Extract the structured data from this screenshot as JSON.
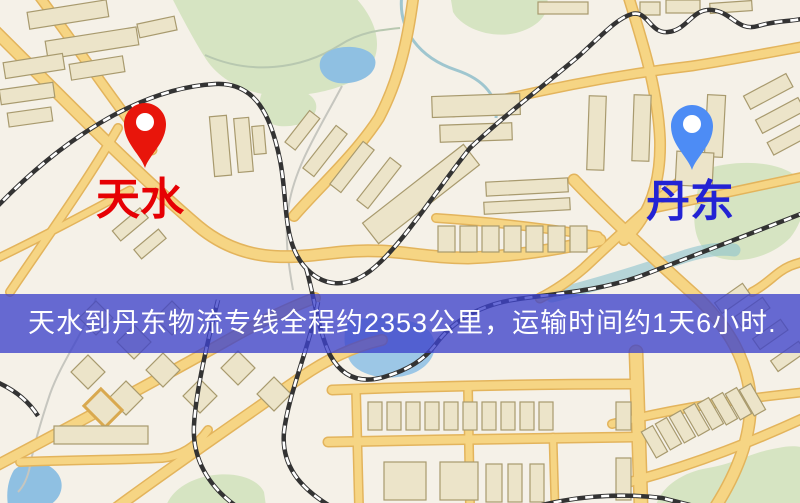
{
  "map": {
    "origin": {
      "name": "天水",
      "pin_color": "#e8150b",
      "label_color": "#e60004"
    },
    "destination": {
      "name": "丹东",
      "pin_color": "#4d8cf5",
      "label_color": "#2323d4"
    },
    "banner": {
      "text": "天水到丹东物流专线全程约2353公里，运输时间约1天6小时.",
      "distance_text": "约2353公里",
      "duration_text": "约1天6小时",
      "bg_color": "rgba(62,66,202,0.78)",
      "text_color": "#ffffff"
    },
    "palette": {
      "background": "#f5f1e8",
      "road_fill": "#f6d584",
      "road_casing": "#e3b45c",
      "park": "#d6e4c2",
      "water": "#8fc0e2",
      "river": "#9fc6cf",
      "building": "#ece4c9",
      "building_outline": "#a89a6e",
      "railway": "#333333"
    }
  }
}
